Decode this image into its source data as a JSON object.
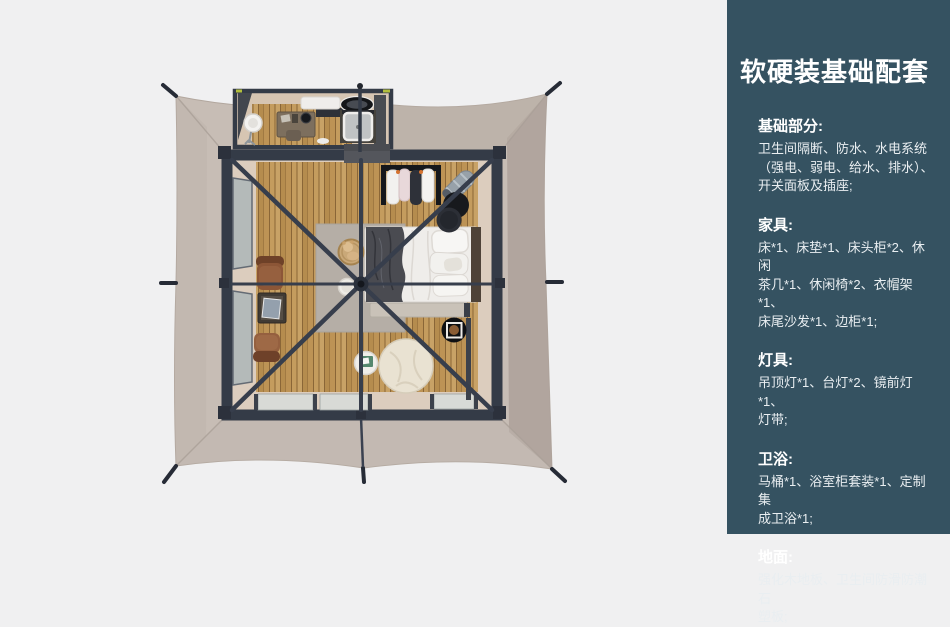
{
  "panel": {
    "title": "软硬装基础配套",
    "colors": {
      "panel_bg": "#355261",
      "panel_text": "#e9eef1",
      "background": "#f0f0f1"
    },
    "sections": [
      {
        "heading": "基础部分:",
        "lines": [
          "卫生间隔断、防水、水电系统",
          "（强电、弱电、给水、排水）、",
          "开关面板及插座;"
        ]
      },
      {
        "heading": "家具:",
        "lines": [
          "床*1、床垫*1、床头柜*2、休闲",
          "茶几*1、休闲椅*2、衣帽架*1、",
          "床尾沙发*1、边柜*1;"
        ]
      },
      {
        "heading": "灯具:",
        "lines": [
          "吊顶灯*1、台灯*2、镜前灯*1、",
          "灯带;"
        ]
      },
      {
        "heading": "卫浴:",
        "lines": [
          "马桶*1、浴室柜套装*1、定制集",
          "成卫浴*1;"
        ]
      },
      {
        "heading": "地面:",
        "lines": [
          "强化木地板、卫生间防滑防潮石",
          "塑板;"
        ]
      }
    ]
  },
  "floorplan": {
    "colors": {
      "canvas": "#c7bdb5",
      "canvas_shadow": "#ab9f99",
      "frame": "#343b47",
      "wood_floor": "#c49c5e",
      "wood_gap": "#8a6637",
      "deck": "#dccdbe",
      "window": "#b4bab9",
      "rug": "#b5aea6",
      "bed": "#efedea",
      "throw": "#4a4b51",
      "chair": "#8c5637",
      "pouf": "#e9e2d2"
    },
    "items": [
      "tent-canvas",
      "guy-line-stakes",
      "center-pole",
      "roof-braces",
      "bathroom",
      "toilet-pedestal",
      "vanity-desk",
      "washbasin",
      "shower-tray",
      "bedroom",
      "bed",
      "pillows",
      "headboard",
      "bed-end-bench",
      "side-cabinet",
      "rug",
      "teddy-basket",
      "round-stool",
      "armchair-1",
      "armchair-2",
      "magazine-table",
      "clothes-rack",
      "luggage-rack",
      "stacked-stools",
      "bean-bag",
      "coffee-table",
      "tray-table",
      "left-windows",
      "bottom-windows"
    ]
  }
}
